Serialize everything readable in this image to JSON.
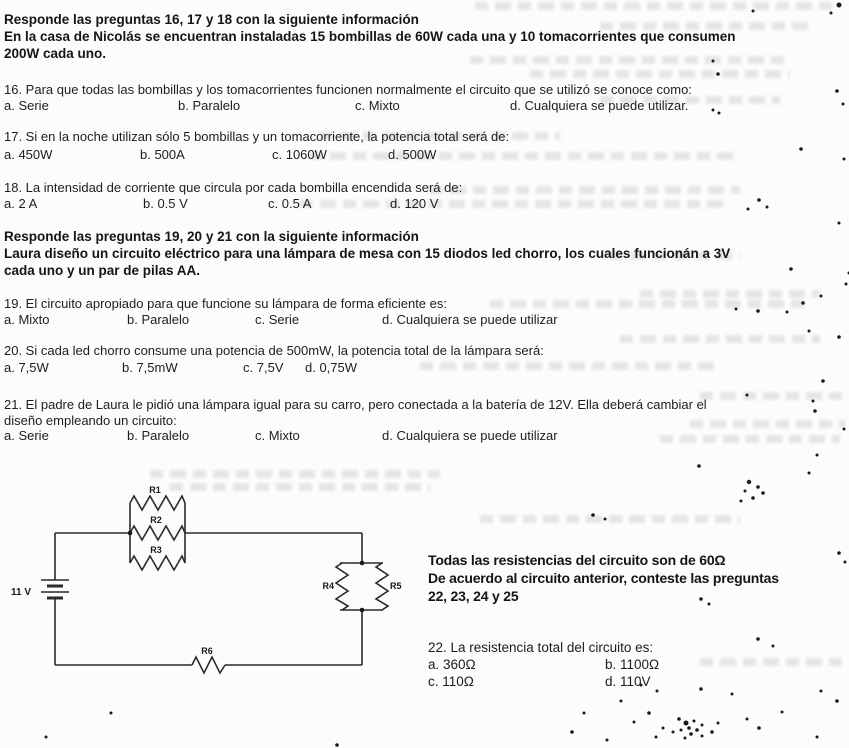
{
  "block1": {
    "header": "Responde las preguntas 16, 17 y 18 con la siguiente información",
    "line2": "En la casa de Nicolás se encuentran instaladas 15 bombillas de 60W cada una y 10 tomacorrientes que consumen",
    "line3": "200W cada uno."
  },
  "q16": {
    "text": "16. Para que todas las bombillas y los tomacorrientes funcionen normalmente el circuito que se utilizó se conoce como:",
    "options": [
      "a. Serie",
      "b. Paralelo",
      "c. Mixto",
      "d. Cualquiera se puede utilizar."
    ]
  },
  "q17": {
    "text": "17. Si en la noche utilizan sólo 5 bombillas y un tomacorriente, la potencia total será de:",
    "options": [
      "a. 450W",
      "b. 500A",
      "c. 1060W",
      "d. 500W"
    ]
  },
  "q18": {
    "text": "18. La intensidad de corriente que circula por cada bombilla encendida será de:",
    "options": [
      "a. 2 A",
      "b. 0.5 V",
      "c. 0.5 A",
      "d. 120 V"
    ]
  },
  "block2": {
    "header": "Responde las preguntas 19, 20 y 21 con la siguiente información",
    "line2": "Laura diseño un circuito eléctrico para una lámpara de mesa con 15 diodos led chorro, los cuales funcionán a 3V",
    "line3": "cada uno y un par de pilas AA."
  },
  "q19": {
    "text": "19. El circuito apropiado para que funcione su lámpara de forma eficiente es:",
    "options": [
      "a. Mixto",
      "b. Paralelo",
      "c. Serie",
      "d. Cualquiera se puede utilizar"
    ]
  },
  "q20": {
    "text": "20. Si cada led chorro consume una potencia de 500mW, la potencia total de la lámpara será:",
    "options": [
      "a. 7,5W",
      "b. 7,5mW",
      "c. 7,5V",
      "d. 0,75W"
    ]
  },
  "q21": {
    "line1": "21. El padre de Laura le pidió una lámpara igual para su carro, pero conectada a la batería de 12V. Ella deberá cambiar el",
    "line2": "diseño empleando un circuito:",
    "options": [
      "a. Serie",
      "b. Paralelo",
      "c. Mixto",
      "d. Cualquiera se puede utilizar"
    ]
  },
  "circuit": {
    "battery_label": "11 V",
    "r1": "R1",
    "r2": "R2",
    "r3": "R3",
    "r4": "R4",
    "r5": "R5",
    "r6": "R6",
    "note1": "Todas las resistencias del circuito son de 60Ω",
    "note2": "De acuerdo al circuito anterior, conteste las preguntas",
    "note3": "22, 23, 24 y 25"
  },
  "q22": {
    "text": "22. La resistencia total del circuito es:",
    "options": [
      "a. 360Ω",
      "b. 1100Ω",
      "c. 110Ω",
      "d. 110V"
    ]
  }
}
